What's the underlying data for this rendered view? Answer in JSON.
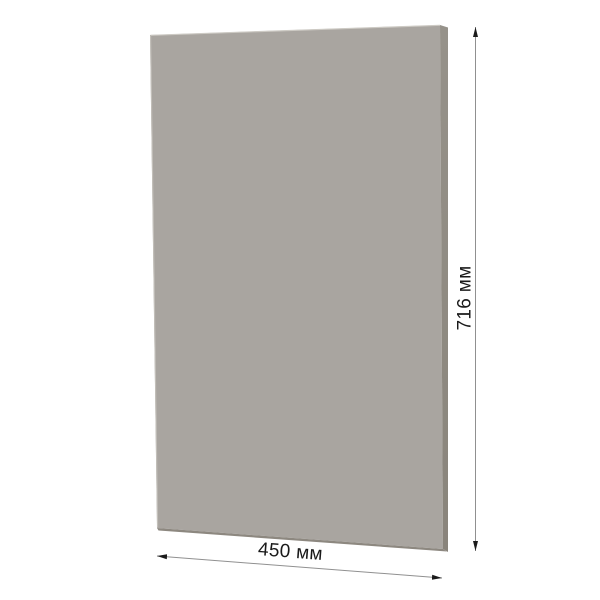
{
  "panel": {
    "face_color": "#a9a5a0",
    "right_edge_top_color": "#96928a",
    "right_edge_bottom_color": "#89847b",
    "bottom_edge_color": "#8d8880",
    "top_highlight_color": "#cdcac4",
    "left_highlight_color": "#c3c0ba"
  },
  "dimensions": {
    "height_label": "716 мм",
    "width_label": "450 мм",
    "line_color": "#909090",
    "arrow_color": "#1b1b1b",
    "text_color": "#1a1a1a"
  },
  "background_color": "#ffffff"
}
